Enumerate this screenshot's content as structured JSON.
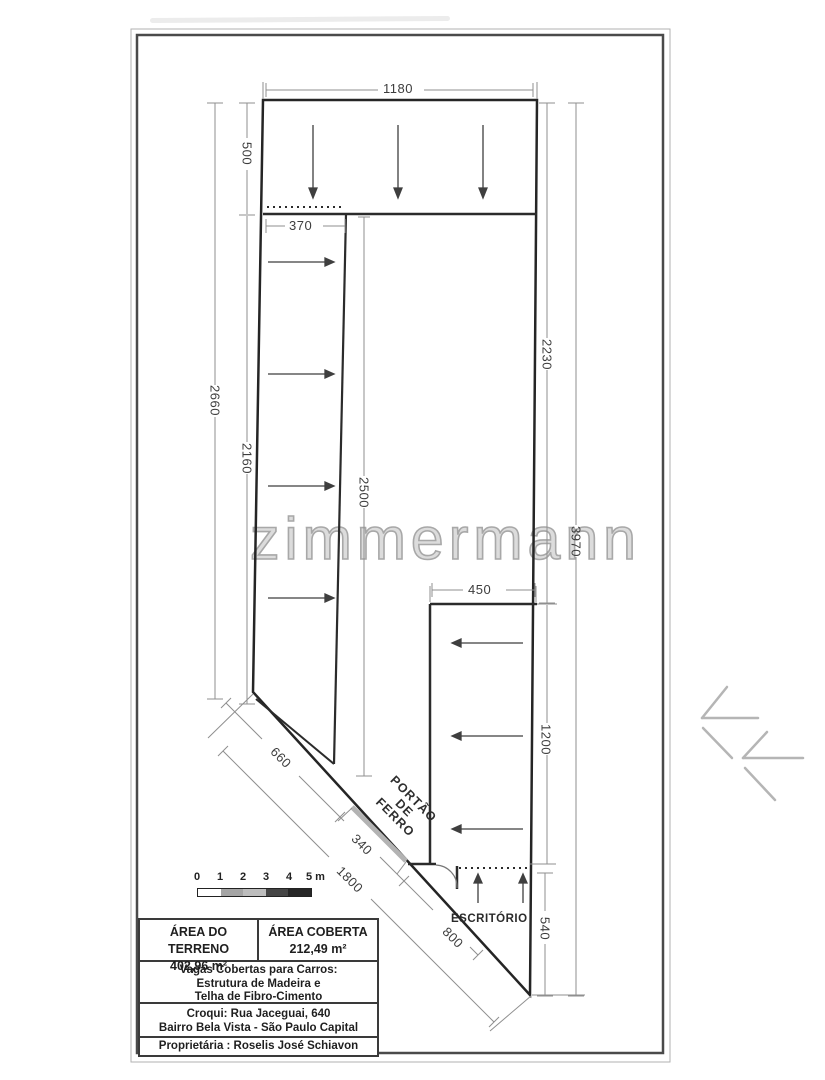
{
  "drawing": {
    "watermark": "zimmermann",
    "dims": {
      "top_width": "1180",
      "strip_width": "370",
      "top_height": "500",
      "left_total": "2660",
      "left_lower": "2160",
      "strip_height": "2500",
      "office_width": "450",
      "right_upper": "2230",
      "right_total": "3970",
      "office_height": "1200",
      "office_lower": "540",
      "diag_upper": "660",
      "diag_gate": "340",
      "diag_total": "1800",
      "diag_lower": "800"
    },
    "gate_label": {
      "line1": "PORTÃO",
      "line2": "DE",
      "line3": "FERRO"
    },
    "office_label": "ESCRITÓRIO"
  },
  "scale_bar": {
    "ticks": [
      "0",
      "1",
      "2",
      "3",
      "4",
      "5 m"
    ],
    "segment_colors": [
      "#ffffff",
      "#a5a5a5",
      "#bdbdbd",
      "#454545",
      "#262626"
    ]
  },
  "info_table": {
    "area_terreno": {
      "label": "ÁREA DO TERRENO",
      "value": "402,96 m²"
    },
    "area_coberta": {
      "label": "ÁREA COBERTA",
      "value": "212,49 m²"
    },
    "structure": {
      "line1": "Vagas Cobertas para Carros:",
      "line2": "Estrutura de Madeira e",
      "line3": "Telha de Fibro-Cimento"
    },
    "address": {
      "line1": "Croqui: Rua Jaceguai, 640",
      "line2": "Bairro Bela Vista - São Paulo Capital"
    },
    "owner": "Proprietária : Roselis José Schiavon"
  }
}
